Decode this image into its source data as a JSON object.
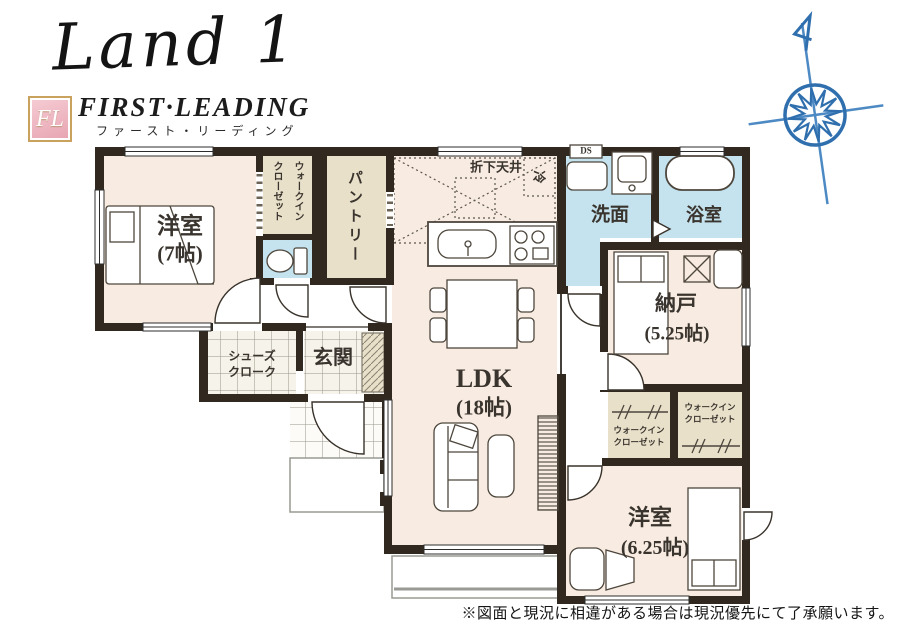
{
  "logo": {
    "brand_script": "Land 1",
    "fl_initials": "FL",
    "brand_caps": "FIRST·LEADING",
    "brand_kana": "ファースト・リーディング"
  },
  "icons": {
    "compass": "compass-rose"
  },
  "disclaimer": "※図面と現況に相違がある場合は現況優先にて了承願います。",
  "rooms": {
    "western_room_1": {
      "name": "洋室",
      "size": "(7帖)"
    },
    "walk_in_closet_top": {
      "line1": "ウォークイン",
      "line2": "クローゼット"
    },
    "pantry": {
      "name": "パントリー"
    },
    "kitchen": {
      "dropped_ceiling": "折下天井",
      "refrigerator": "冷"
    },
    "washroom": {
      "name": "洗面",
      "duct": "DS"
    },
    "bathroom": {
      "name": "浴室"
    },
    "storage_room": {
      "name": "納戸",
      "size": "(5.25帖)"
    },
    "walk_in_closet_left": {
      "line1": "ウォークイン",
      "line2": "クローゼット"
    },
    "walk_in_closet_right": {
      "line1": "ウォークイン",
      "line2": "クローゼット"
    },
    "shoes_closet": {
      "line1": "シューズ",
      "line2": "クローク"
    },
    "entrance": {
      "name": "玄関"
    },
    "ldk": {
      "name": "LDK",
      "size": "(18帖)"
    },
    "western_room_2": {
      "name": "洋室",
      "size": "(6.25帖)"
    }
  },
  "colors": {
    "wall": "#312820",
    "floor": "#f8ece2",
    "closet": "#e9e0ca",
    "wet_area": "#c5e3ee",
    "compass": "#2f6fae"
  }
}
